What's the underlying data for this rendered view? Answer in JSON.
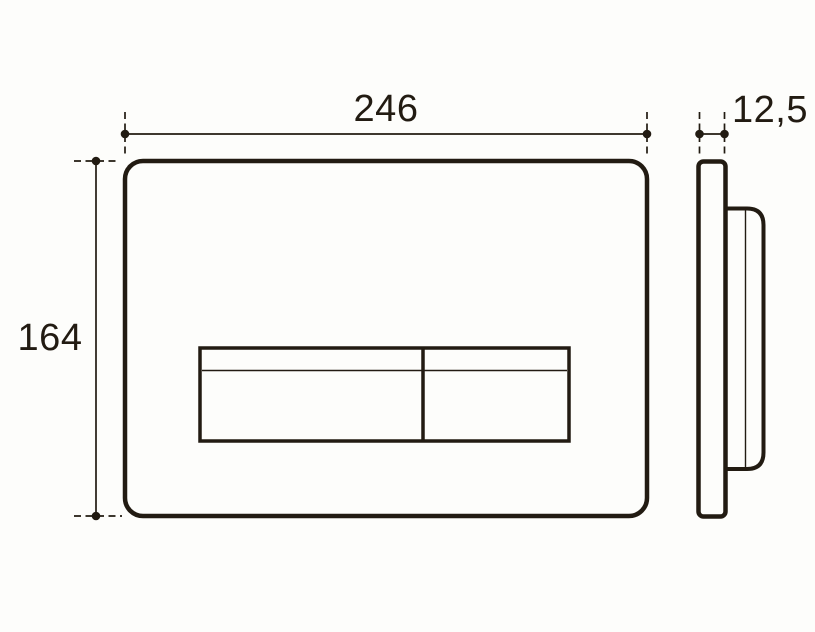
{
  "diagram": {
    "type": "technical-dimension-drawing",
    "views": {
      "front": "front-view",
      "side": "side-view"
    },
    "dimensions": {
      "width": "246",
      "height": "164",
      "depth": "12,5"
    },
    "colors": {
      "line": "#221b12",
      "background": "#fdfdfb"
    }
  }
}
